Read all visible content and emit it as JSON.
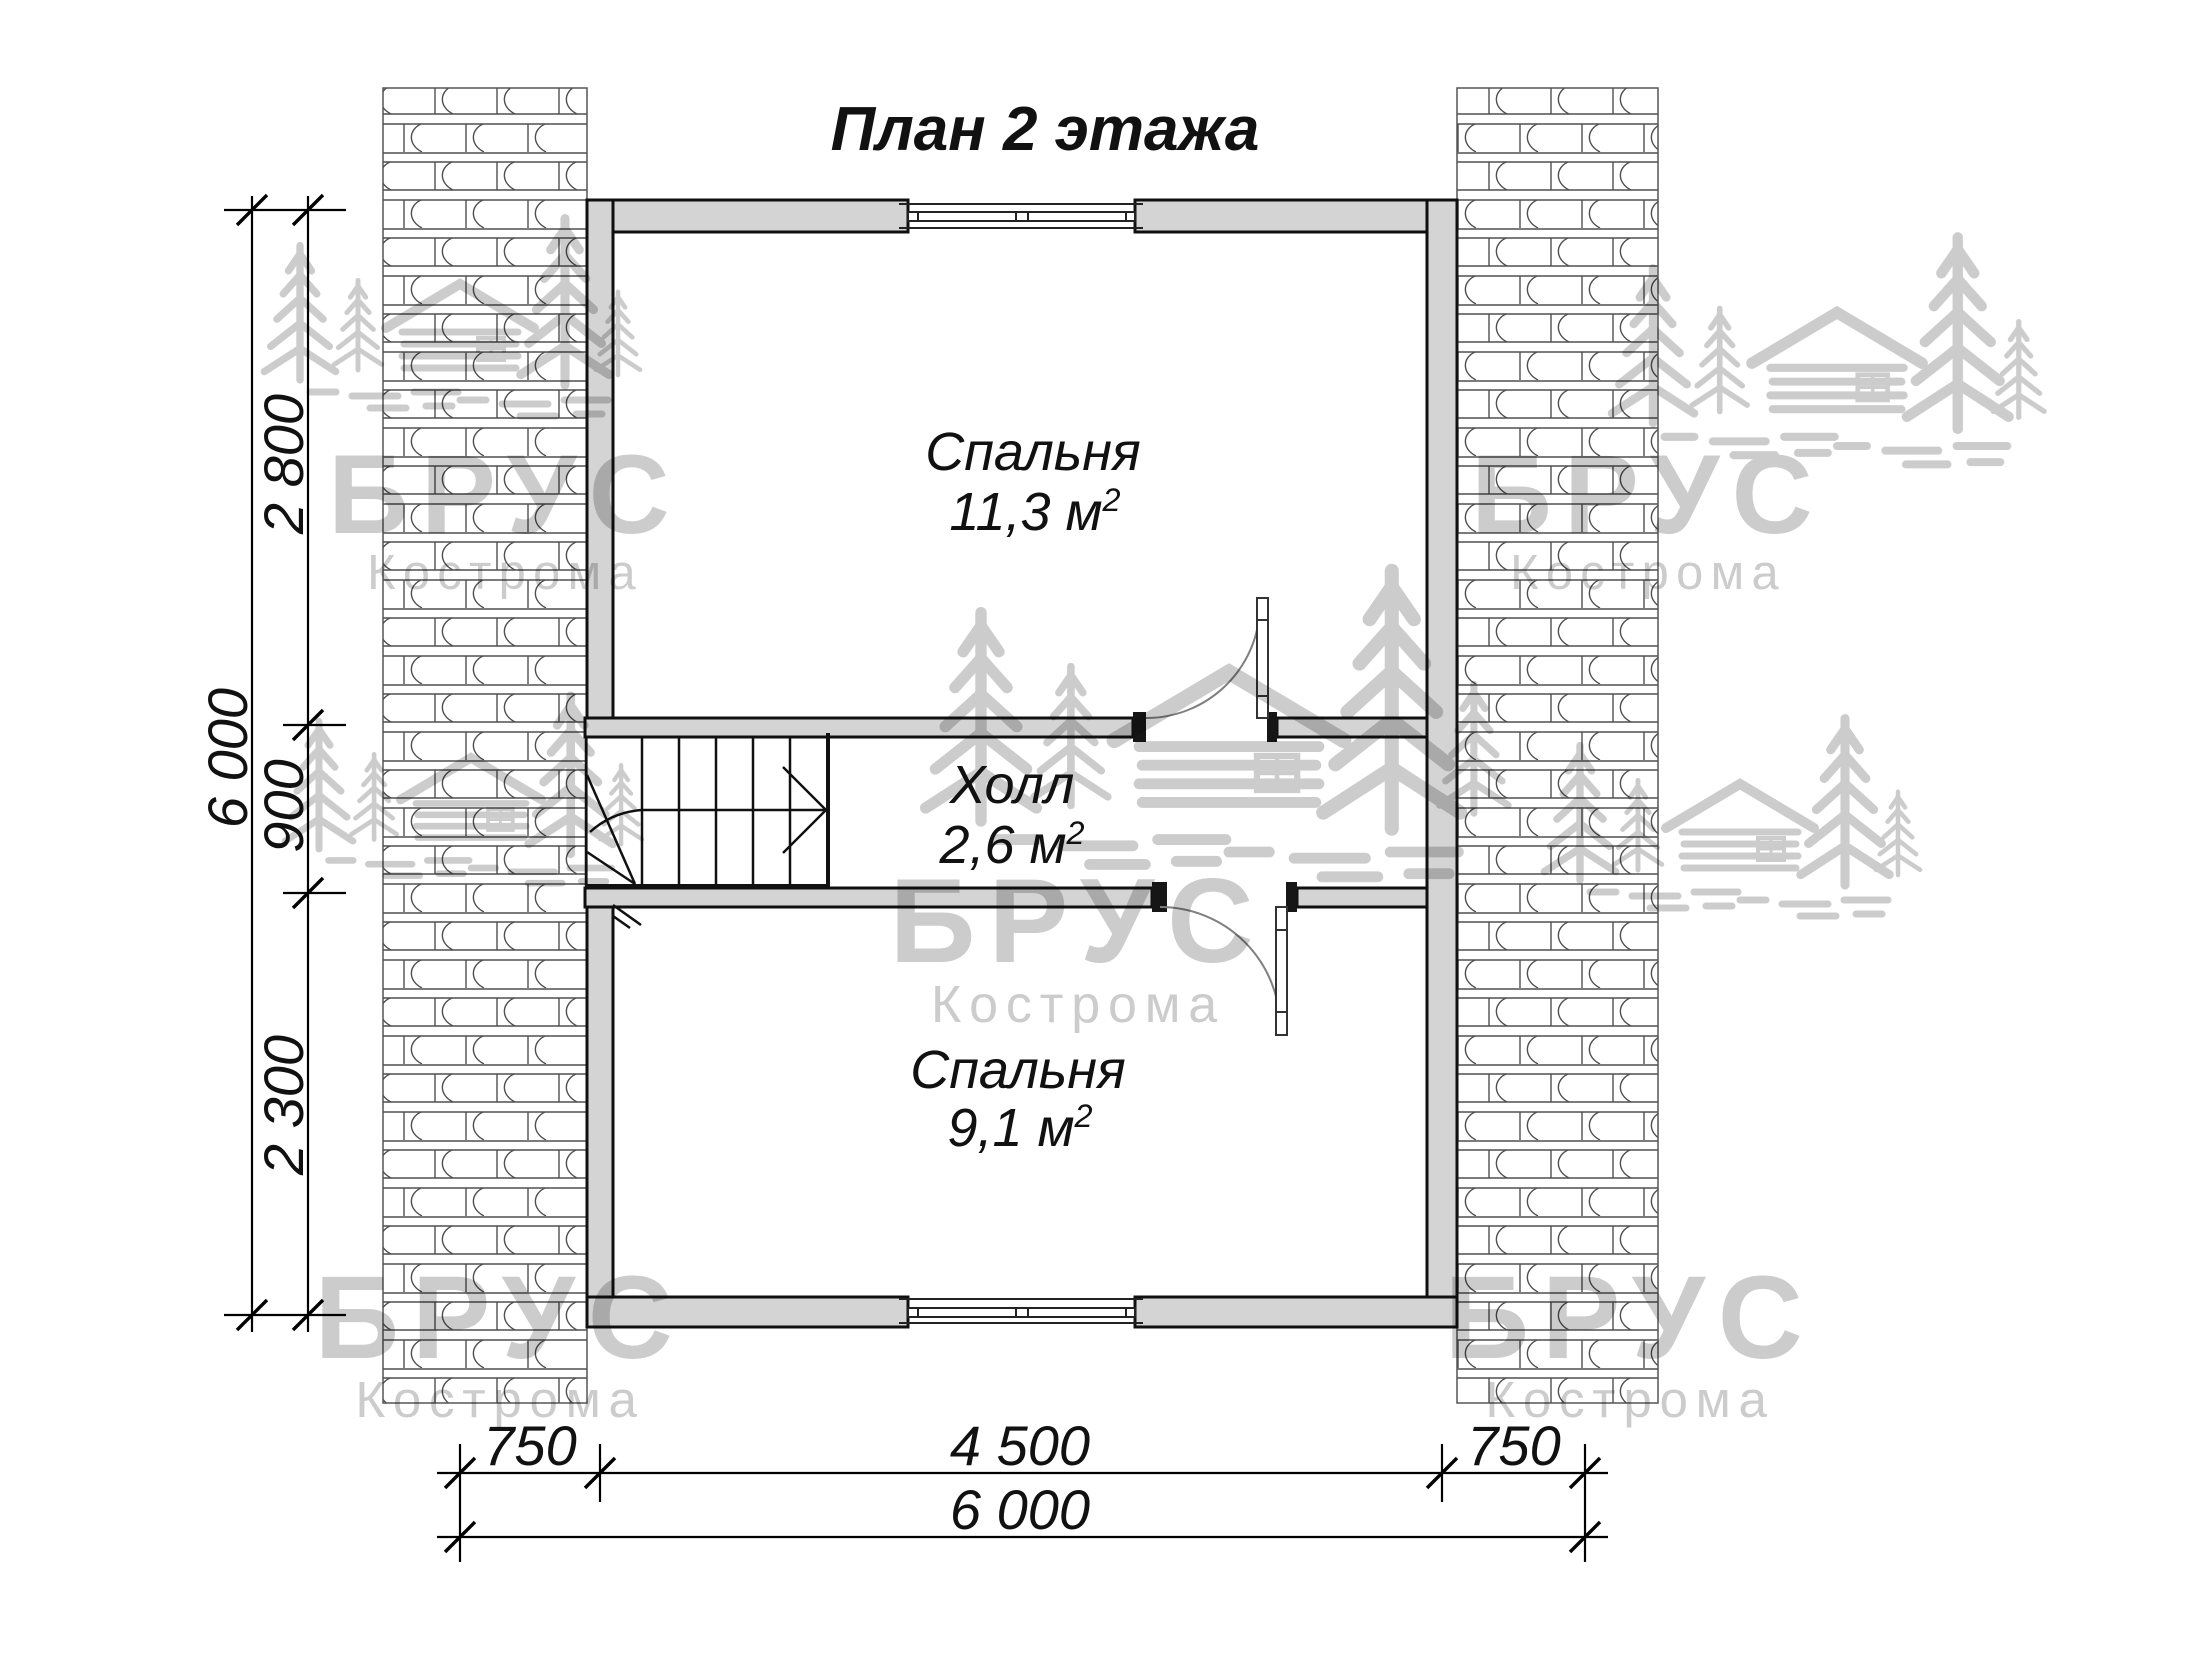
{
  "title": "План 2 этажа",
  "rooms": [
    {
      "name": "Спальня",
      "area": "11,3 м",
      "area_sup": "2"
    },
    {
      "name": "Холл",
      "area": "2,6 м",
      "area_sup": "2"
    },
    {
      "name": "Спальня",
      "area": "9,1 м",
      "area_sup": "2"
    }
  ],
  "dimensions": {
    "left_segments": [
      "2 800",
      "900",
      "2 300"
    ],
    "left_total": "6 000",
    "bottom_segments": [
      "750",
      "4 500",
      "750"
    ],
    "bottom_total": "6 000"
  },
  "watermark": {
    "brand": "БРУС",
    "city": "Кострома"
  },
  "colors": {
    "wall_fill": "#d4d4d4",
    "drawing_line": "#111111",
    "watermark_gray": "#c3c3c3"
  }
}
